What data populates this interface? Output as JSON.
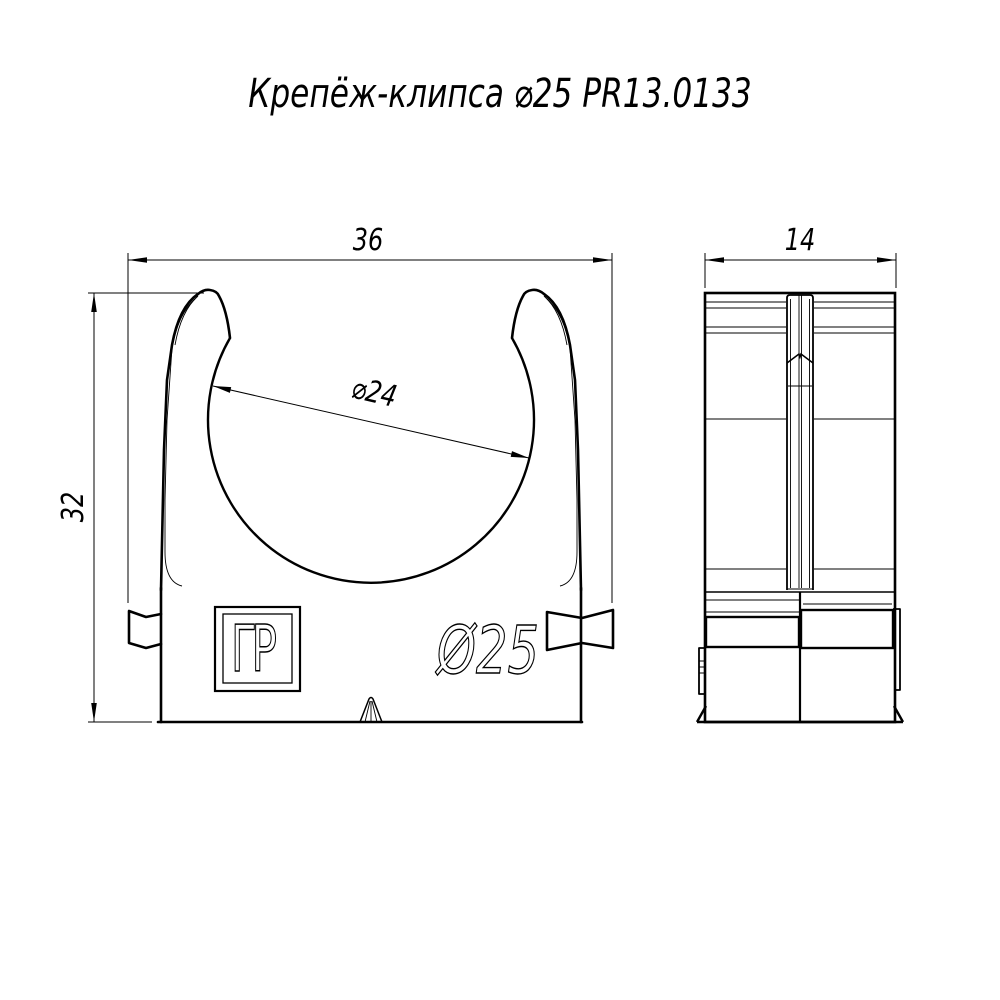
{
  "title": "Крепёж-клипса ⌀25 PR13.0133",
  "views": {
    "front": {
      "label": "front view of pipe clip"
    },
    "side": {
      "label": "side view of pipe clip"
    }
  },
  "dimensions": {
    "overall_width": "36",
    "overall_height": "32",
    "bore_diameter": "⌀24",
    "depth": "14"
  },
  "markings": {
    "embossed_size": "Ø25",
    "logo_monogram": "ГР"
  },
  "colors": {
    "line": "#000000",
    "background": "#ffffff"
  }
}
